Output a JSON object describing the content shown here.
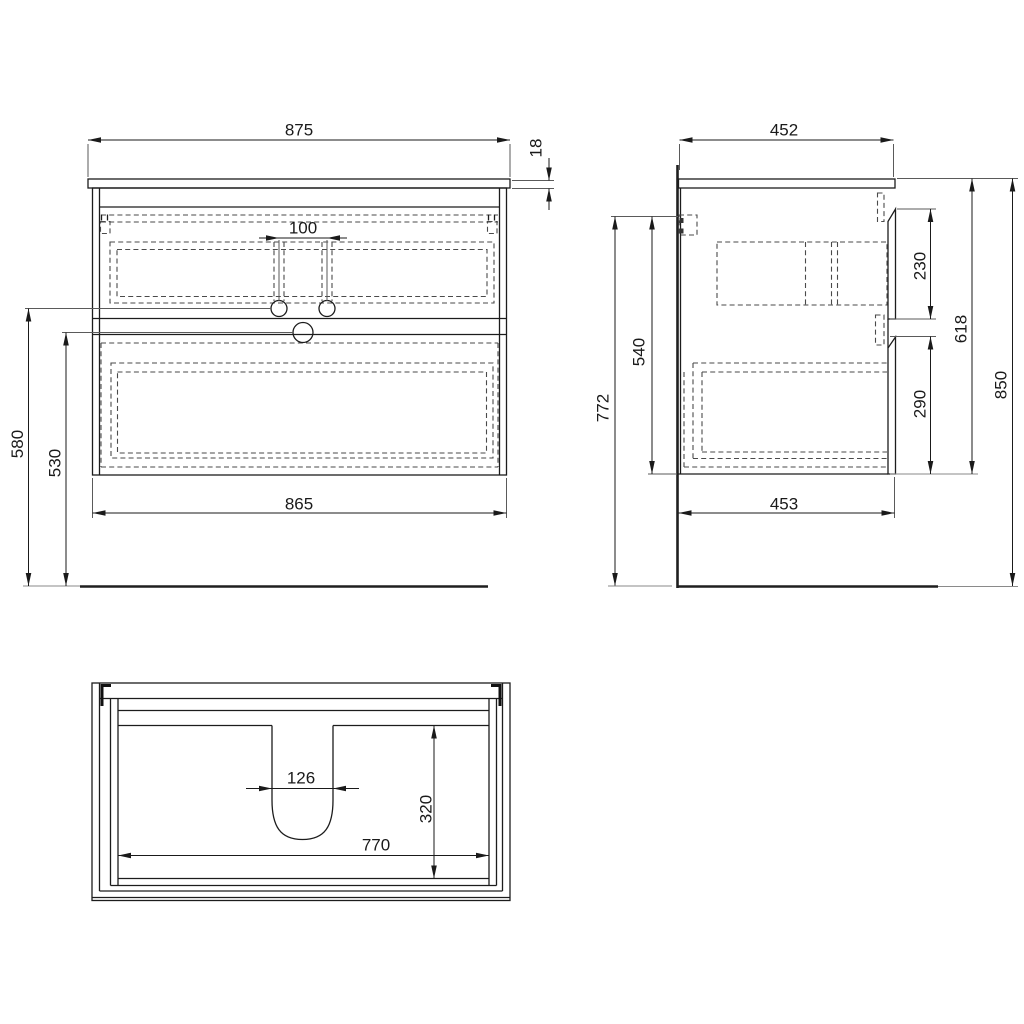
{
  "views": {
    "front": {
      "dims": {
        "overall_width": "875",
        "countertop_thickness": "18",
        "faucet_hole_spacing": "100",
        "cabinet_width": "865",
        "faucet_hole_height": "580",
        "drain_height": "530"
      }
    },
    "side": {
      "dims": {
        "countertop_depth": "452",
        "upper_drawer_front_height": "230",
        "cabinet_height": "618",
        "overall_height": "850",
        "mount_to_cabinet_bottom": "540",
        "mount_to_floor": "772",
        "lower_drawer_front_height": "290",
        "cabinet_depth": "453"
      }
    },
    "plan": {
      "dims": {
        "siphon_cutout_width": "126",
        "siphon_cutout_depth": "320",
        "interior_width": "770"
      }
    }
  }
}
